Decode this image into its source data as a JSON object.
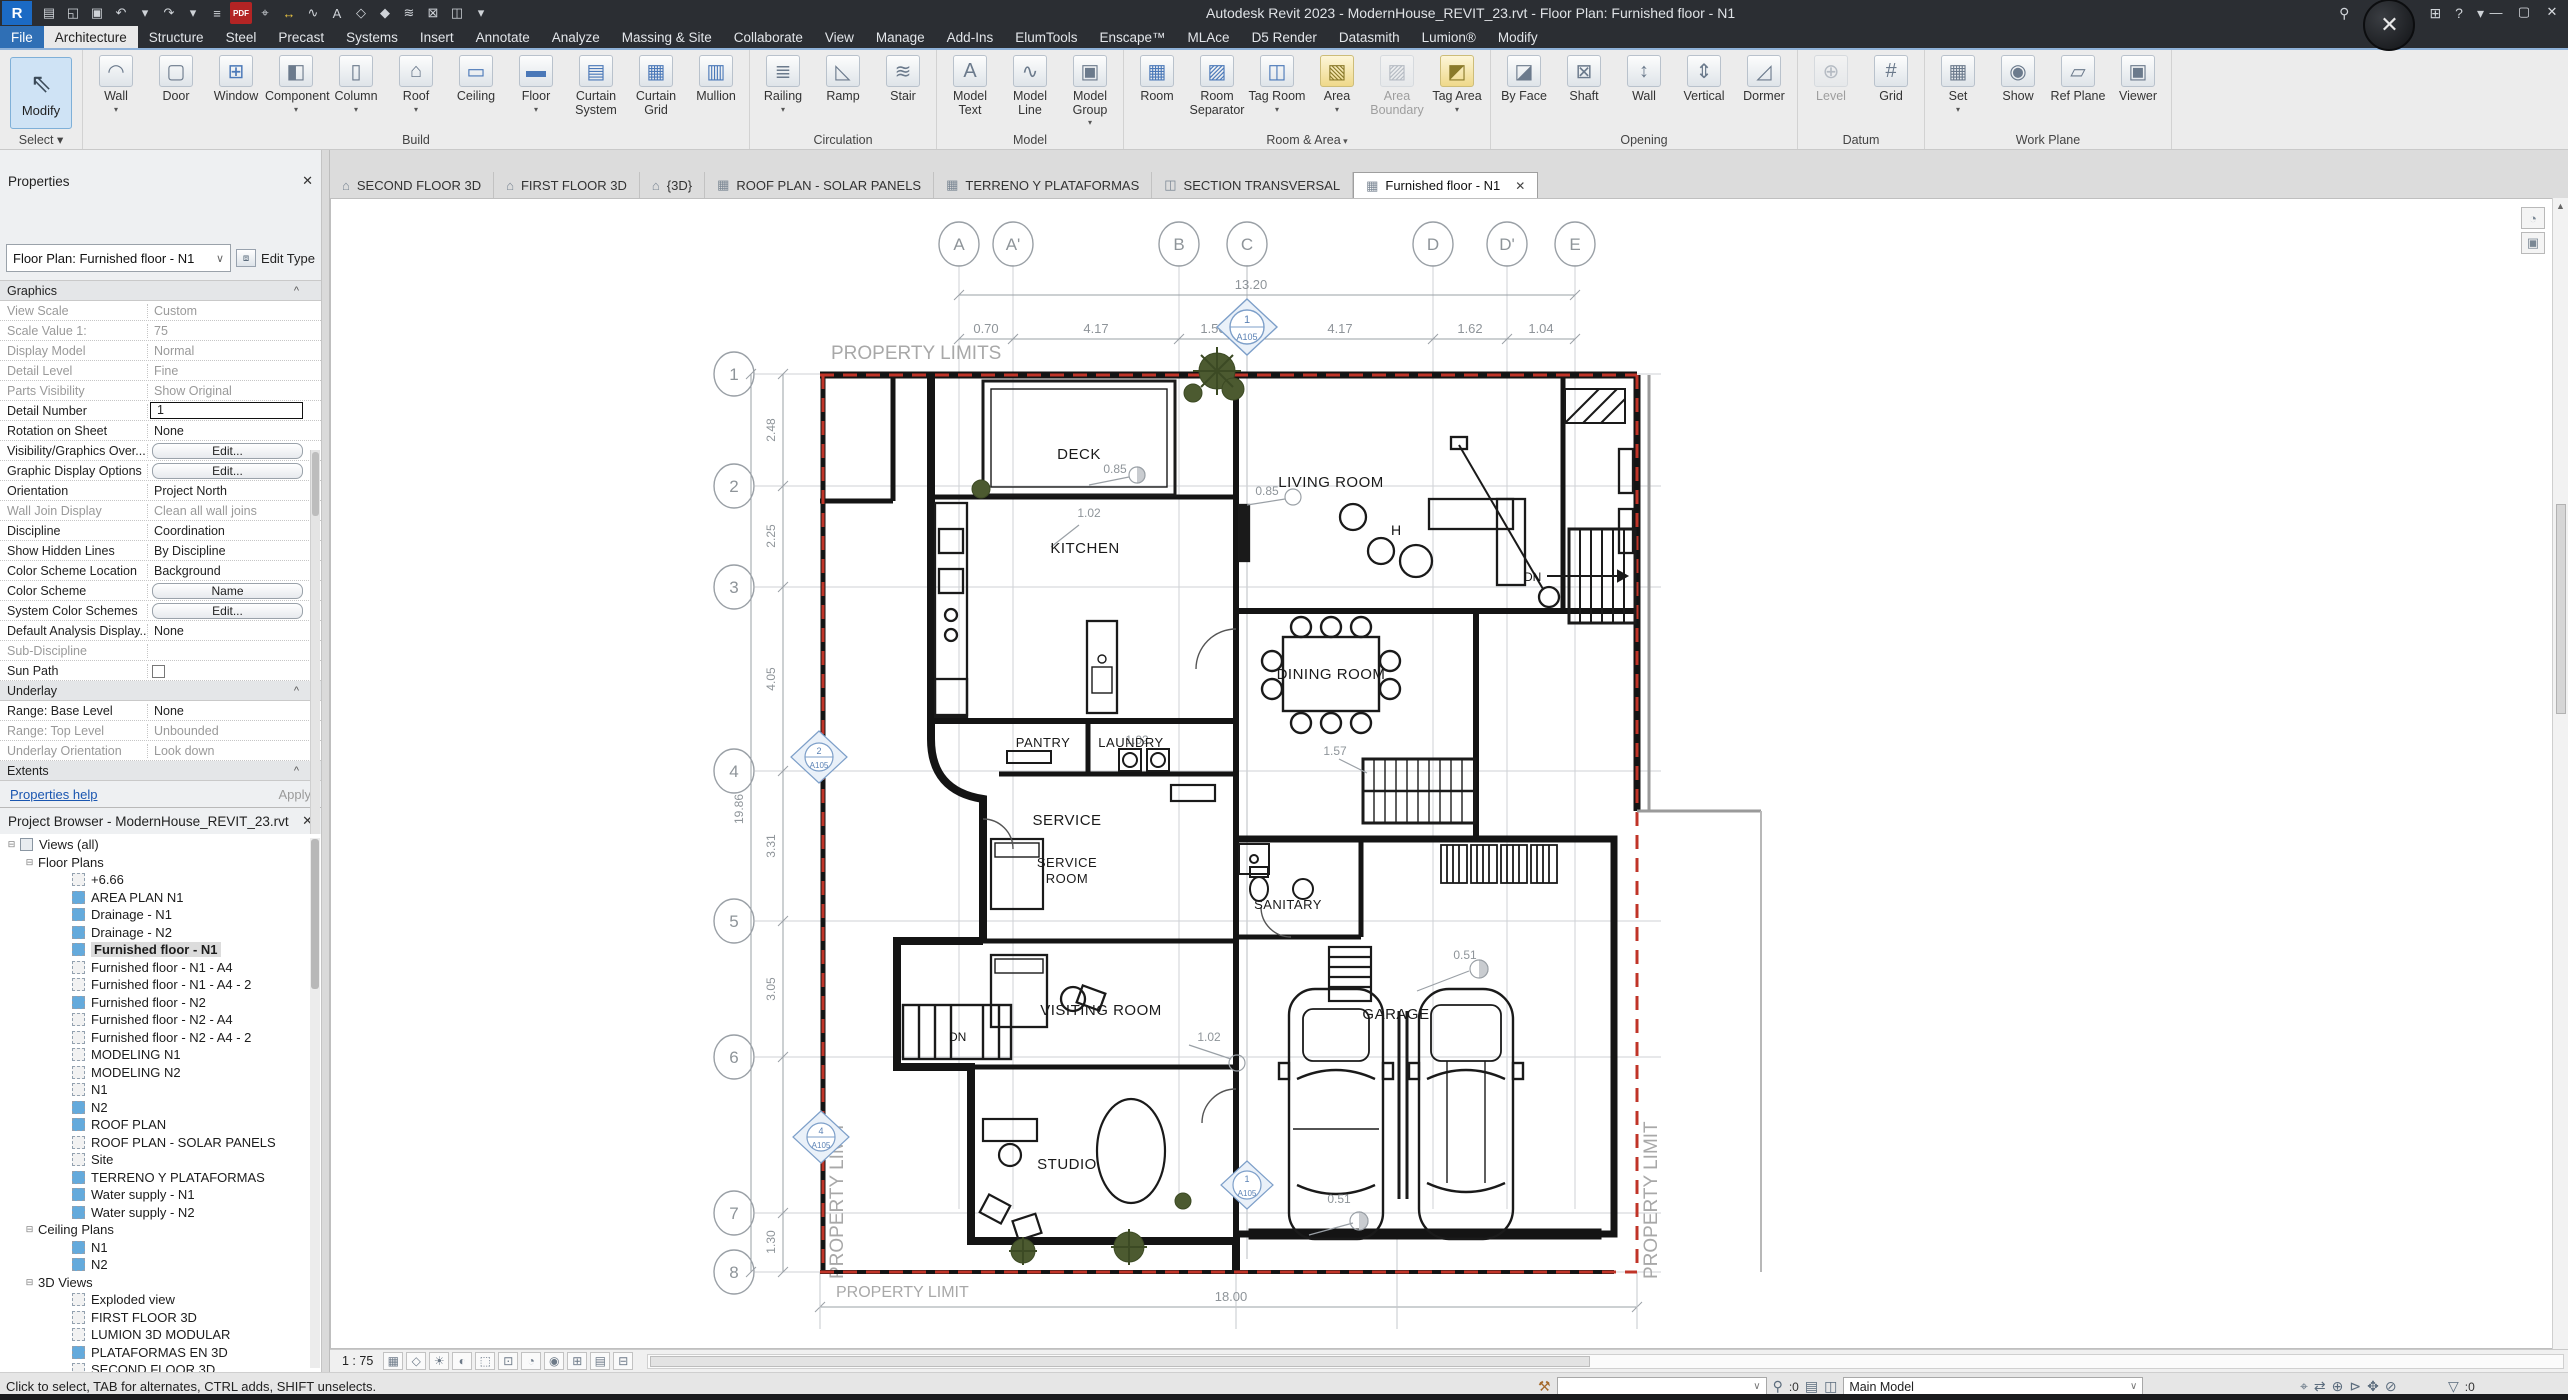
{
  "colors": {
    "accent_blue": "#2f6fb5",
    "selection_fill": "#cfe3f5",
    "boundary_red": "#c03428",
    "marker_blue": "#7d9fc9",
    "tree_icon_blue": "#64aadc",
    "tab_dark": "#2b2e33"
  },
  "titlebar": {
    "title": "Autodesk Revit 2023 - ModernHouse_REVIT_23.rvt - Floor Plan: Furnished floor - N1",
    "logo": "R",
    "avatar_glyph": "✕",
    "search_glyph": "⚲",
    "cart_glyph": "⊞",
    "help_glyph": "?",
    "dropdown_glyph": "▾",
    "win": {
      "min": "—",
      "max": "▢",
      "close": "✕"
    },
    "qat": [
      {
        "g": "▤",
        "name": "properties-icon"
      },
      {
        "g": "◱",
        "name": "open-icon"
      },
      {
        "g": "▣",
        "name": "save-icon"
      },
      {
        "g": "↶",
        "name": "undo-icon"
      },
      {
        "g": "▾",
        "name": "undo-drop-icon"
      },
      {
        "g": "↷",
        "name": "redo-icon"
      },
      {
        "g": "▾",
        "name": "redo-drop-icon"
      },
      {
        "g": "≡",
        "name": "print-icon"
      },
      {
        "g": "PDF",
        "name": "export-pdf-icon",
        "cls": "pdf"
      },
      {
        "g": "⌖",
        "name": "measure-icon"
      },
      {
        "g": "↔",
        "name": "aligned-dimension-icon",
        "cls": "yellow"
      },
      {
        "g": "∿",
        "name": "detail-line-icon"
      },
      {
        "g": "A",
        "name": "text-icon"
      },
      {
        "g": "◇",
        "name": "default-3d-view-icon"
      },
      {
        "g": "◆",
        "name": "section-icon"
      },
      {
        "g": "≋",
        "name": "thin-lines-icon"
      },
      {
        "g": "⊠",
        "name": "close-hidden-windows-icon"
      },
      {
        "g": "◫",
        "name": "switch-windows-icon"
      },
      {
        "g": "▾",
        "name": "customize-qat-icon"
      }
    ]
  },
  "ribbon_tabs": [
    {
      "label": "File",
      "cls": "file"
    },
    {
      "label": "Architecture",
      "cls": "active"
    },
    {
      "label": "Structure"
    },
    {
      "label": "Steel"
    },
    {
      "label": "Precast"
    },
    {
      "label": "Systems"
    },
    {
      "label": "Insert"
    },
    {
      "label": "Annotate"
    },
    {
      "label": "Analyze"
    },
    {
      "label": "Massing & Site"
    },
    {
      "label": "Collaborate"
    },
    {
      "label": "View"
    },
    {
      "label": "Manage"
    },
    {
      "label": "Add-Ins"
    },
    {
      "label": "ElumTools"
    },
    {
      "label": "Enscape™"
    },
    {
      "label": "MLAce"
    },
    {
      "label": "D5 Render"
    },
    {
      "label": "Datasmith"
    },
    {
      "label": "Lumion®"
    },
    {
      "label": "Modify"
    }
  ],
  "ribbon": {
    "modify_label": "Modify",
    "select_label": "Select",
    "panels": [
      {
        "title": "Build",
        "items": [
          {
            "label": "Wall",
            "icon": "◠",
            "name": "wall-button",
            "cls": "arr"
          },
          {
            "label": "Door",
            "icon": "▢",
            "name": "door-button"
          },
          {
            "label": "Window",
            "icon": "⊞",
            "name": "window-button",
            "cls": "blue"
          },
          {
            "label": "Component",
            "icon": "◧",
            "name": "component-button",
            "cls": "arr"
          },
          {
            "label": "Column",
            "icon": "▯",
            "name": "column-button",
            "cls": "arr"
          },
          {
            "label": "Roof",
            "icon": "⌂",
            "name": "roof-button",
            "cls": "arr"
          },
          {
            "label": "Ceiling",
            "icon": "▭",
            "name": "ceiling-button",
            "cls": "blue"
          },
          {
            "label": "Floor",
            "icon": "▬",
            "name": "floor-button",
            "cls": "arr blue"
          },
          {
            "label": "Curtain System",
            "icon": "▤",
            "name": "curtain-system-button",
            "cls": "blue"
          },
          {
            "label": "Curtain Grid",
            "icon": "▦",
            "name": "curtain-grid-button",
            "cls": "blue"
          },
          {
            "label": "Mullion",
            "icon": "▥",
            "name": "mullion-button",
            "cls": "blue"
          }
        ]
      },
      {
        "title": "Circulation",
        "items": [
          {
            "label": "Railing",
            "icon": "≣",
            "name": "railing-button",
            "cls": "arr"
          },
          {
            "label": "Ramp",
            "icon": "◺",
            "name": "ramp-button"
          },
          {
            "label": "Stair",
            "icon": "≋",
            "name": "stair-button"
          }
        ]
      },
      {
        "title": "Model",
        "items": [
          {
            "label": "Model Text",
            "icon": "A",
            "name": "model-text-button"
          },
          {
            "label": "Model Line",
            "icon": "∿",
            "name": "model-line-button"
          },
          {
            "label": "Model Group",
            "icon": "▣",
            "name": "model-group-button",
            "cls": "arr"
          }
        ]
      },
      {
        "title": "Room & Area",
        "cls": "arr",
        "items": [
          {
            "label": "Room",
            "icon": "▦",
            "name": "room-button",
            "cls": "blue"
          },
          {
            "label": "Room Separator",
            "icon": "▨",
            "name": "room-separator-button",
            "cls": "blue"
          },
          {
            "label": "Tag Room",
            "icon": "◫",
            "name": "tag-room-button",
            "cls": "arr blue"
          },
          {
            "label": "Area",
            "icon": "▧",
            "name": "area-button",
            "cls": "arr yellow"
          },
          {
            "label": "Area Boundary",
            "icon": "▨",
            "name": "area-boundary-button",
            "cls": "disabled"
          },
          {
            "label": "Tag Area",
            "icon": "◩",
            "name": "tag-area-button",
            "cls": "arr yellow"
          }
        ]
      },
      {
        "title": "Opening",
        "items": [
          {
            "label": "By Face",
            "icon": "◪",
            "name": "by-face-button"
          },
          {
            "label": "Shaft",
            "icon": "⊠",
            "name": "shaft-button"
          },
          {
            "label": "Wall",
            "icon": "↕",
            "name": "wall-opening-button"
          },
          {
            "label": "Vertical",
            "icon": "⇕",
            "name": "vertical-opening-button"
          },
          {
            "label": "Dormer",
            "icon": "◿",
            "name": "dormer-button"
          }
        ]
      },
      {
        "title": "Datum",
        "items": [
          {
            "label": "Level",
            "icon": "⊕",
            "name": "level-button",
            "cls": "disabled"
          },
          {
            "label": "Grid",
            "icon": "#",
            "name": "grid-button"
          }
        ]
      },
      {
        "title": "Work Plane",
        "items": [
          {
            "label": "Set",
            "icon": "▦",
            "name": "set-workplane-button",
            "cls": "arr"
          },
          {
            "label": "Show",
            "icon": "◉",
            "name": "show-workplane-button"
          },
          {
            "label": "Ref Plane",
            "icon": "▱",
            "name": "ref-plane-button"
          },
          {
            "label": "Viewer",
            "icon": "▣",
            "name": "viewer-button"
          }
        ]
      }
    ]
  },
  "view_tabs": [
    {
      "label": "SECOND FLOOR 3D",
      "icon": "⌂"
    },
    {
      "label": "FIRST FLOOR 3D",
      "icon": "⌂"
    },
    {
      "label": "{3D}",
      "icon": "⌂"
    },
    {
      "label": "ROOF PLAN - SOLAR PANELS",
      "icon": "▦"
    },
    {
      "label": "TERRENO Y PLATAFORMAS",
      "icon": "▦"
    },
    {
      "label": "SECTION TRANSVERSAL",
      "icon": "◫"
    },
    {
      "label": "Furnished floor - N1",
      "icon": "▦",
      "cls": "active",
      "close": "✕"
    }
  ],
  "properties": {
    "header": "Properties",
    "close": "✕",
    "type_selector": "Floor Plan: Furnished floor - N1",
    "edit_type": "Edit Type",
    "rows": [
      {
        "label": "Graphics",
        "value": "",
        "cls": "section"
      },
      {
        "label": "View Scale",
        "value": "Custom",
        "cls": "ro"
      },
      {
        "label": "Scale Value    1:",
        "value": "75",
        "cls": "ro"
      },
      {
        "label": "Display Model",
        "value": "Normal",
        "cls": "ro"
      },
      {
        "label": "Detail Level",
        "value": "Fine",
        "cls": "ro"
      },
      {
        "label": "Parts Visibility",
        "value": "Show Original",
        "cls": "ro"
      },
      {
        "label": "Detail Number",
        "value": "1",
        "cls": "input"
      },
      {
        "label": "Rotation on Sheet",
        "value": "None"
      },
      {
        "label": "Visibility/Graphics Over...",
        "value": "Edit...",
        "cls": "btn"
      },
      {
        "label": "Graphic Display Options",
        "value": "Edit...",
        "cls": "btn"
      },
      {
        "label": "Orientation",
        "value": "Project North"
      },
      {
        "label": "Wall Join Display",
        "value": "Clean all wall joins",
        "cls": "ro"
      },
      {
        "label": "Discipline",
        "value": "Coordination"
      },
      {
        "label": "Show Hidden Lines",
        "value": "By Discipline"
      },
      {
        "label": "Color Scheme Location",
        "value": "Background"
      },
      {
        "label": "Color Scheme",
        "value": "Name",
        "cls": "btn"
      },
      {
        "label": "System Color Schemes",
        "value": "Edit...",
        "cls": "btn"
      },
      {
        "label": "Default Analysis Display...",
        "value": "None"
      },
      {
        "label": "Sub-Discipline",
        "value": "",
        "cls": "ro"
      },
      {
        "label": "Sun Path",
        "value": "",
        "cls": "check"
      },
      {
        "label": "Underlay",
        "value": "",
        "cls": "section"
      },
      {
        "label": "Range: Base Level",
        "value": "None"
      },
      {
        "label": "Range: Top Level",
        "value": "Unbounded",
        "cls": "ro"
      },
      {
        "label": "Underlay Orientation",
        "value": "Look down",
        "cls": "ro"
      },
      {
        "label": "Extents",
        "value": "",
        "cls": "section"
      }
    ],
    "footer": {
      "help": "Properties help",
      "apply": "Apply"
    }
  },
  "browser": {
    "header": "Project Browser - ModernHouse_REVIT_23.rvt",
    "close": "✕",
    "items": [
      {
        "label": "Views (all)",
        "cls": "lvl0 root"
      },
      {
        "label": "Floor Plans",
        "cls": "lvl1 cat"
      },
      {
        "label": "+6.66",
        "cls": "lvl2 white"
      },
      {
        "label": "AREA PLAN N1",
        "cls": "lvl2 blue"
      },
      {
        "label": "Drainage - N1",
        "cls": "lvl2 blue"
      },
      {
        "label": "Drainage - N2",
        "cls": "lvl2 blue"
      },
      {
        "label": "Furnished floor - N1",
        "cls": "lvl2 blue sel"
      },
      {
        "label": "Furnished floor - N1 - A4",
        "cls": "lvl2 white"
      },
      {
        "label": "Furnished floor - N1 - A4 - 2",
        "cls": "lvl2 white"
      },
      {
        "label": "Furnished floor - N2",
        "cls": "lvl2 blue"
      },
      {
        "label": "Furnished floor - N2 - A4",
        "cls": "lvl2 white"
      },
      {
        "label": "Furnished floor - N2 - A4 - 2",
        "cls": "lvl2 white"
      },
      {
        "label": "MODELING N1",
        "cls": "lvl2 white"
      },
      {
        "label": "MODELING N2",
        "cls": "lvl2 white"
      },
      {
        "label": "N1",
        "cls": "lvl2 white"
      },
      {
        "label": "N2",
        "cls": "lvl2 blue"
      },
      {
        "label": "ROOF PLAN",
        "cls": "lvl2 blue"
      },
      {
        "label": "ROOF PLAN - SOLAR PANELS",
        "cls": "lvl2 white"
      },
      {
        "label": "Site",
        "cls": "lvl2 white"
      },
      {
        "label": "TERRENO Y PLATAFORMAS",
        "cls": "lvl2 blue"
      },
      {
        "label": "Water supply - N1",
        "cls": "lvl2 blue"
      },
      {
        "label": "Water supply - N2",
        "cls": "lvl2 blue"
      },
      {
        "label": "Ceiling Plans",
        "cls": "lvl1 cat"
      },
      {
        "label": "N1",
        "cls": "lvl2 blue"
      },
      {
        "label": "N2",
        "cls": "lvl2 blue"
      },
      {
        "label": "3D Views",
        "cls": "lvl1 cat"
      },
      {
        "label": "Exploded view",
        "cls": "lvl2 white"
      },
      {
        "label": "FIRST FLOOR 3D",
        "cls": "lvl2 white"
      },
      {
        "label": "LUMION 3D MODULAR",
        "cls": "lvl2 white"
      },
      {
        "label": "PLATAFORMAS EN 3D",
        "cls": "lvl2 blue"
      },
      {
        "label": "SECOND FLOOR 3D",
        "cls": "lvl2 white"
      }
    ]
  },
  "plan": {
    "grid_cols": [
      "A",
      "A'",
      "B",
      "C",
      "D",
      "D'",
      "E"
    ],
    "grid_rows": [
      "1",
      "2",
      "3",
      "4",
      "5",
      "6",
      "7",
      "8"
    ],
    "dim_overall_top": "13.20",
    "top_dims": [
      "0.70",
      "4.17",
      "1.50",
      "4.17",
      "1.62",
      "1.04"
    ],
    "left_dims": [
      "2.48",
      "2.25",
      "4.05",
      "3.31",
      "3.05",
      "1.30"
    ],
    "dim_overall_left": "19.86",
    "dim_bottom": "18.00",
    "rooms": [
      "DECK",
      "LIVING ROOM",
      "KITCHEN",
      "DINING ROOM",
      "PANTRY",
      "LAUNDRY",
      "SERVICE",
      "SERVICE",
      "ROOM",
      "SANITARY",
      "VISITING ROOM",
      "GARAGE",
      "STUDIO"
    ],
    "labels": {
      "property_limits": "PROPERTY LIMITS",
      "property_limit": "PROPERTY LIMIT",
      "dn": "DN",
      "column_h": "H"
    },
    "small_dims": [
      "0.85",
      "0.85",
      "1.02",
      "1.02",
      "1.57",
      "1.02",
      "0.51",
      "0.51"
    ],
    "marker": {
      "num": "1",
      "num2": "2",
      "num4": "4",
      "sheet": "A105"
    }
  },
  "view_bar": {
    "scale": "1 : 75",
    "icons": [
      {
        "g": "▦",
        "name": "detail-level-icon"
      },
      {
        "g": "◇",
        "name": "visual-style-icon"
      },
      {
        "g": "☀",
        "name": "sun-path-icon"
      },
      {
        "g": "◐",
        "name": "shadows-icon"
      },
      {
        "g": "⬚",
        "name": "crop-view-icon"
      },
      {
        "g": "⊡",
        "name": "show-crop-icon"
      },
      {
        "g": "◔",
        "name": "temporary-hide-icon"
      },
      {
        "g": "◉",
        "name": "reveal-hidden-icon"
      },
      {
        "g": "⊞",
        "name": "worksharing-display-icon"
      },
      {
        "g": "▤",
        "name": "temporary-view-properties-icon"
      },
      {
        "g": "⊟",
        "name": "reveal-constraints-icon"
      }
    ]
  },
  "status": {
    "hint": "Click to select, TAB for alternates, CTRL adds, SHIFT unselects.",
    "workset_glyph": "⚒",
    "editable_glyph": "⚲",
    "editable_count": ":0",
    "main_model": "Main Model",
    "filter_glyph": "▽",
    "filter_count": ":0",
    "right_icons": [
      {
        "g": "⌖",
        "name": "select-links-icon"
      },
      {
        "g": "⇄",
        "name": "select-underlay-icon"
      },
      {
        "g": "⊕",
        "name": "select-pinned-icon"
      },
      {
        "g": "⊳",
        "name": "select-by-face-icon"
      },
      {
        "g": "✥",
        "name": "drag-on-selection-icon"
      },
      {
        "g": "⊘",
        "name": "background-process-icon"
      }
    ]
  }
}
